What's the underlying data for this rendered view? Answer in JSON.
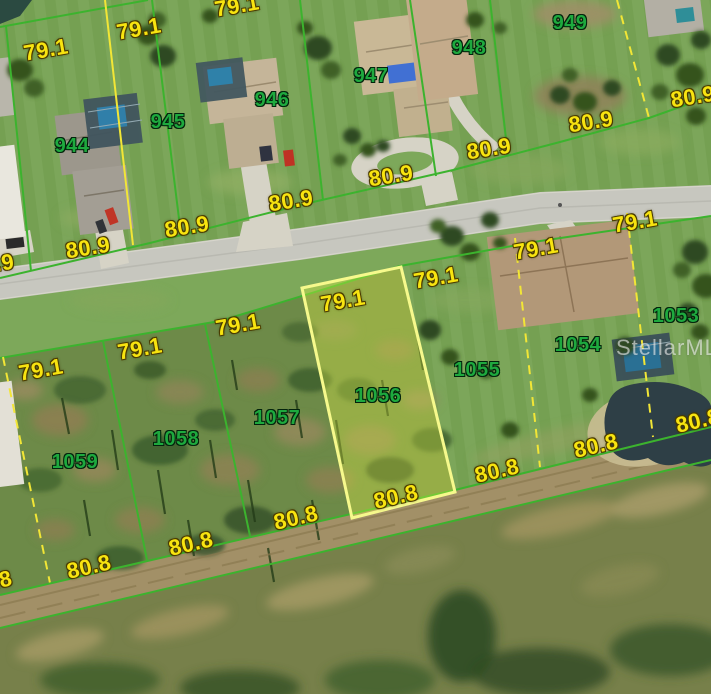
{
  "watermark": "StellarMLS",
  "dims": {
    "front": "79.1",
    "road": "80.9",
    "rear": "80.8"
  },
  "lots": {
    "top": [
      "944",
      "945",
      "946",
      "947",
      "948",
      "949"
    ],
    "bottom": [
      "1059",
      "1058",
      "1057",
      "1056",
      "1055",
      "1054",
      "1053"
    ]
  },
  "highlighted_lot": "1056",
  "colors": {
    "boundary-green": "#3cb32e",
    "boundary-yellow": "#f2e636",
    "highlight-border": "#f6f98c",
    "highlight-fill": "rgba(236,250,70,0.32)",
    "dim-text": "#f8e410",
    "lot-text": "#1ea93e",
    "road": "#c7c7bf",
    "watermark-text": "rgba(255,255,255,0.55)"
  }
}
